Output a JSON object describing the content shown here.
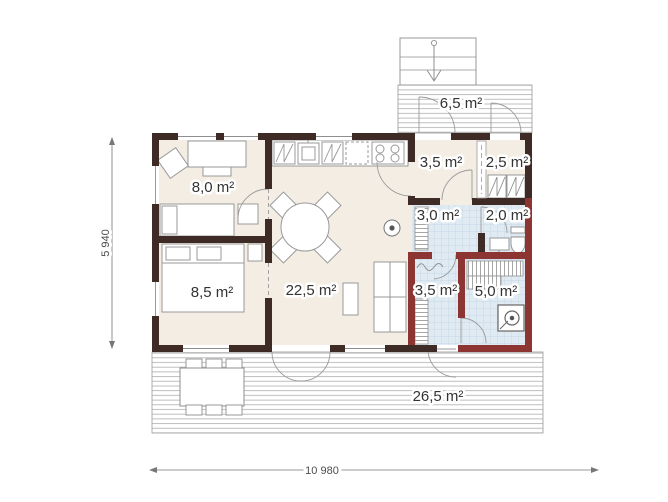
{
  "plan": {
    "rooms": {
      "bedroom_small": "8,0 m²",
      "bedroom_large": "8,5 m²",
      "living": "22,5 m²",
      "entry": "3,5 m²",
      "storage": "2,5 m²",
      "hallway": "3,0 m²",
      "bathroom": "2,0 m²",
      "washroom": "3,5 m²",
      "sauna": "5,0 m²",
      "deck_top": "6,5 m²",
      "deck_main": "26,5 m²"
    },
    "dimensions": {
      "total_width": "10 980",
      "total_height": "5 940"
    },
    "colors": {
      "wall": "#3e2b26",
      "wet_wall": "#8d3533",
      "floor": "#f4ede4",
      "tile": "#e0eaf2",
      "tile_grid": "#bdd2e2",
      "deck_line": "#aeaeae",
      "furniture_stroke": "#999999",
      "text": "#333333"
    }
  }
}
